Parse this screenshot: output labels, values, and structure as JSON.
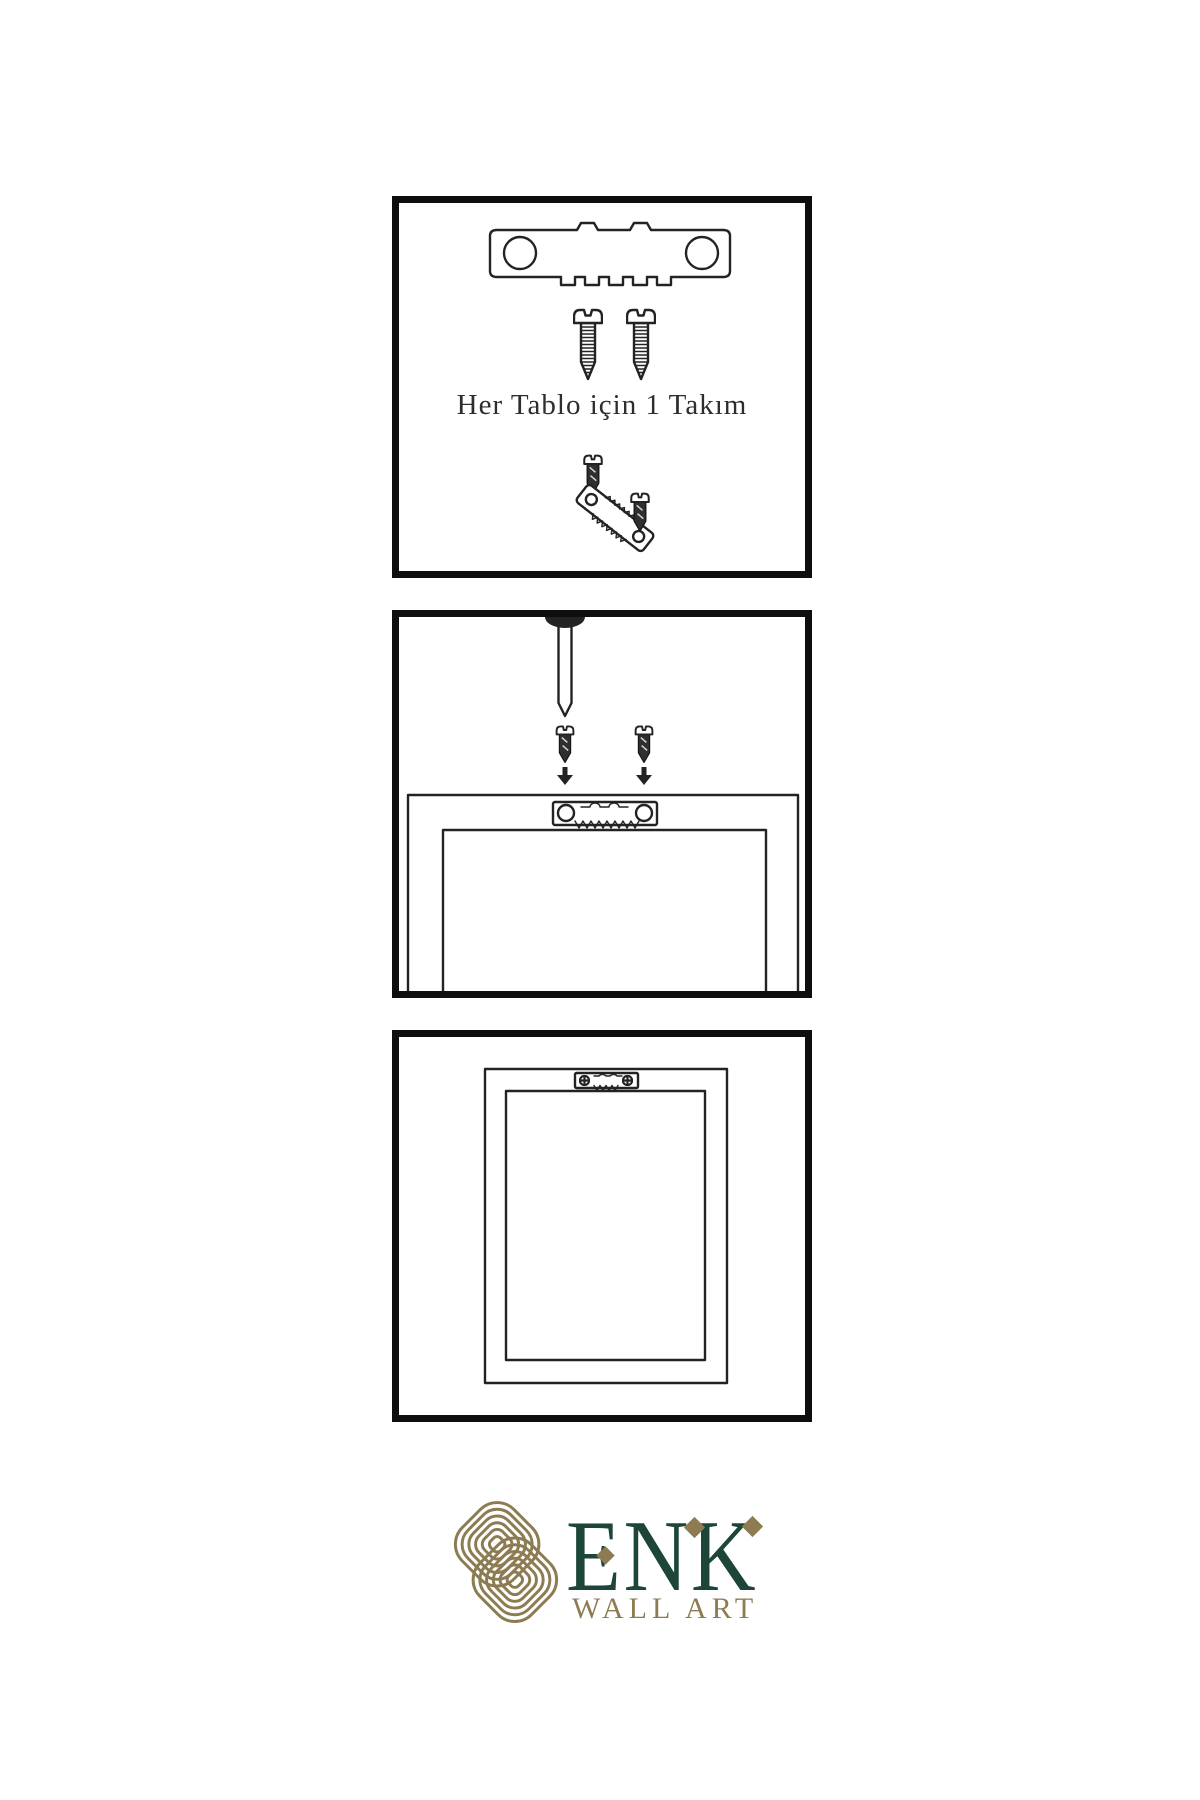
{
  "panels": [
    {
      "name": "hardware-kit",
      "caption": "Her Tablo için 1 Takım",
      "icons": [
        "sawtooth-hanger-icon",
        "screw-icon",
        "screw-icon",
        "tilted-hanger-with-screws-icon"
      ]
    },
    {
      "name": "installation-step",
      "icons": [
        "nail-icon",
        "screw-icon",
        "screw-icon",
        "arrow-down-icon",
        "arrow-down-icon",
        "frame-back-icon",
        "sawtooth-hanger-icon"
      ]
    },
    {
      "name": "mounted-frame",
      "icons": [
        "frame-back-icon",
        "mounted-sawtooth-hanger-icon",
        "phillips-screw-icon",
        "phillips-screw-icon"
      ]
    }
  ],
  "logo": {
    "brand": "ENK",
    "subtitle": "WALL ART",
    "emblem": "knot-emblem-icon"
  },
  "colors": {
    "ink": "#232323",
    "panel_border": "#0e0e0e",
    "logo_green": "#1d4639",
    "logo_gold": "#8d7c52",
    "page_bg": "#ffffff"
  }
}
